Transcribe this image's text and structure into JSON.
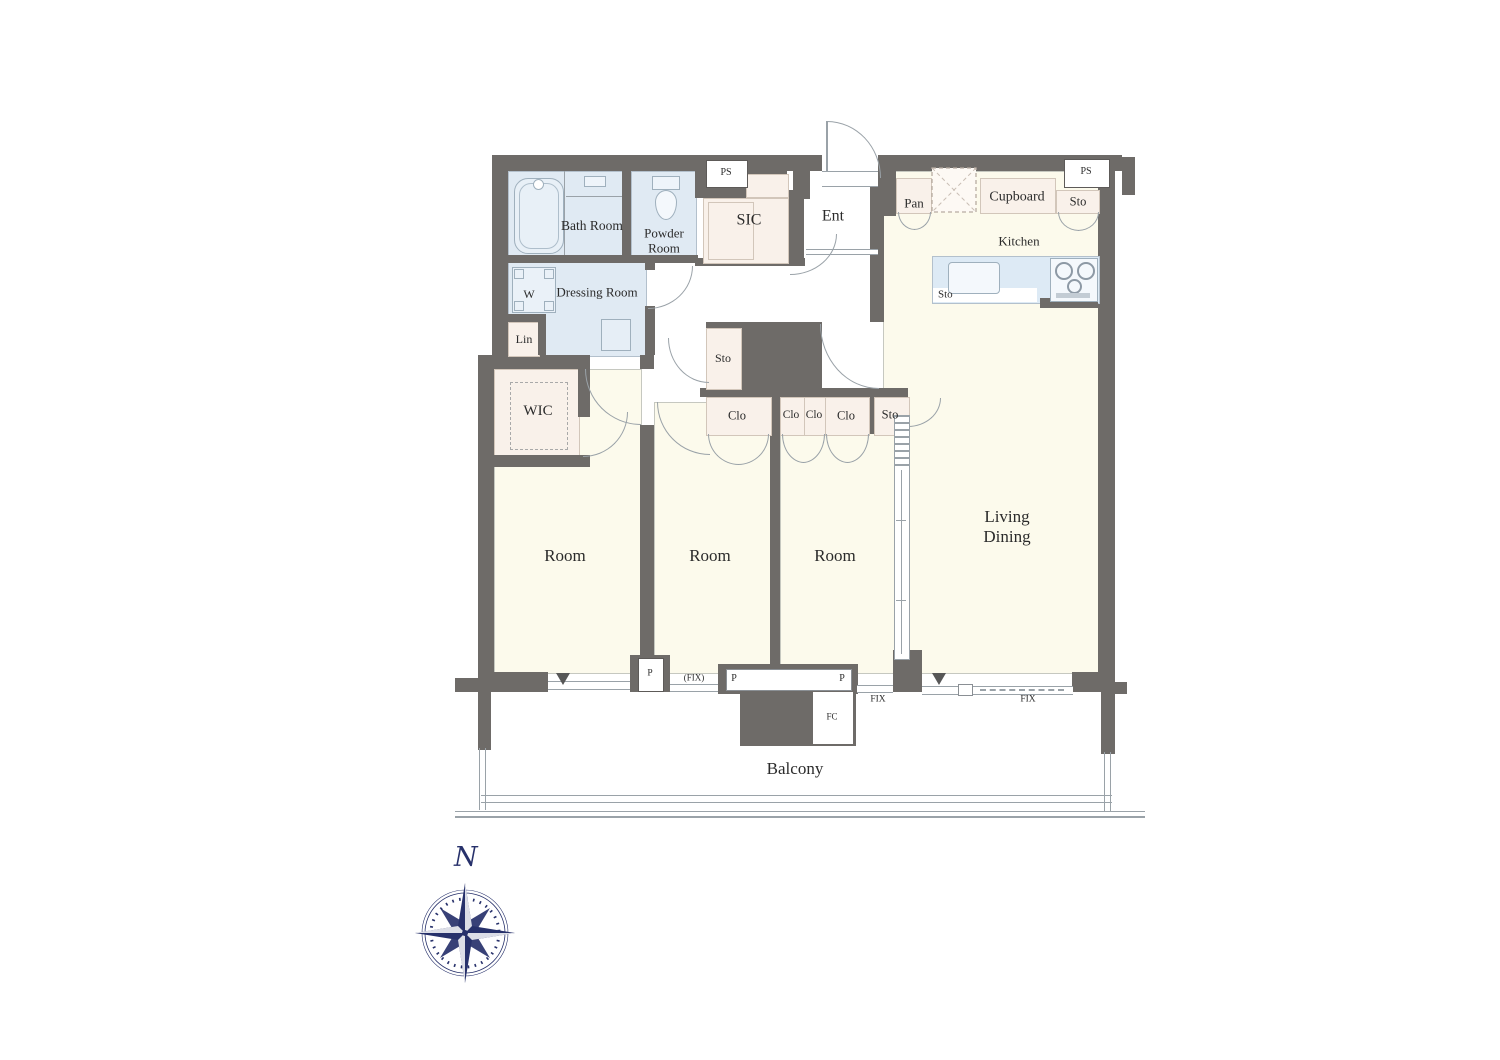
{
  "colors": {
    "wall": "#6e6b68",
    "floor": "#fcfaec",
    "wet": "#e0eaf3",
    "closet": "#f9f1ea",
    "counter": "#ddeaf5",
    "line": "#9aa2a8",
    "ink": "#2b2b2b",
    "navy": "#27316b"
  },
  "labels": {
    "bath_room": "Bath Room",
    "powder_room": "Powder Room",
    "dressing_room": "Dressing Room",
    "washer": "W",
    "lin": "Lin",
    "wic": "WIC",
    "sic": "SIC",
    "ent": "Ent",
    "ps": "PS",
    "pan": "Pan",
    "cupboard": "Cupboard",
    "kitchen": "Kitchen",
    "sto": "Sto",
    "clo": "Clo",
    "room": "Room",
    "living_dining": "Living Dining",
    "balcony": "Balcony",
    "p": "P",
    "fix": "FIX",
    "fix_paren": "(FIX)",
    "fc": "FC",
    "north": "N"
  }
}
